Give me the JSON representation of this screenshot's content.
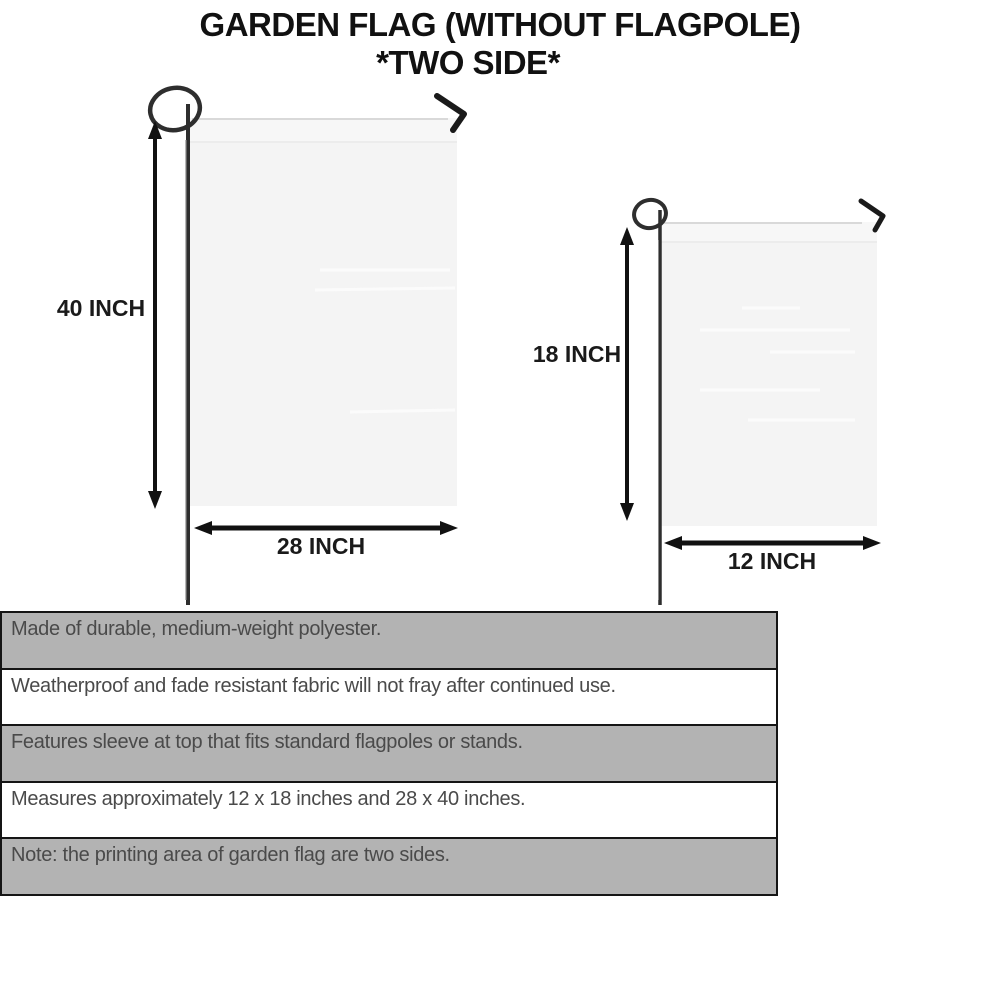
{
  "title": {
    "line1": "GARDEN FLAG (WITHOUT FLAGPOLE)",
    "line2": "*TWO SIDE*"
  },
  "flags": {
    "large": {
      "height_label": "40 INCH",
      "width_label": "28 INCH"
    },
    "small": {
      "height_label": "18 INCH",
      "width_label": "12 INCH"
    }
  },
  "features": [
    "Made of durable, medium-weight polyester.",
    "Weatherproof and fade resistant fabric will not fray after continued use.",
    "Features sleeve at top that fits standard flagpoles or stands.",
    "Measures approximately 12 x 18 inches and 28 x 40 inches.",
    "Note: the printing area of garden flag are two sides."
  ],
  "colors": {
    "row_shaded": "#b3b3b3",
    "row_plain": "#ffffff",
    "table_border": "#151515",
    "feature_text": "#4a4a4a",
    "title_text": "#111111",
    "flag_fill": "#f4f4f4",
    "pole": "#2e2e2e",
    "arrow": "#111111"
  }
}
